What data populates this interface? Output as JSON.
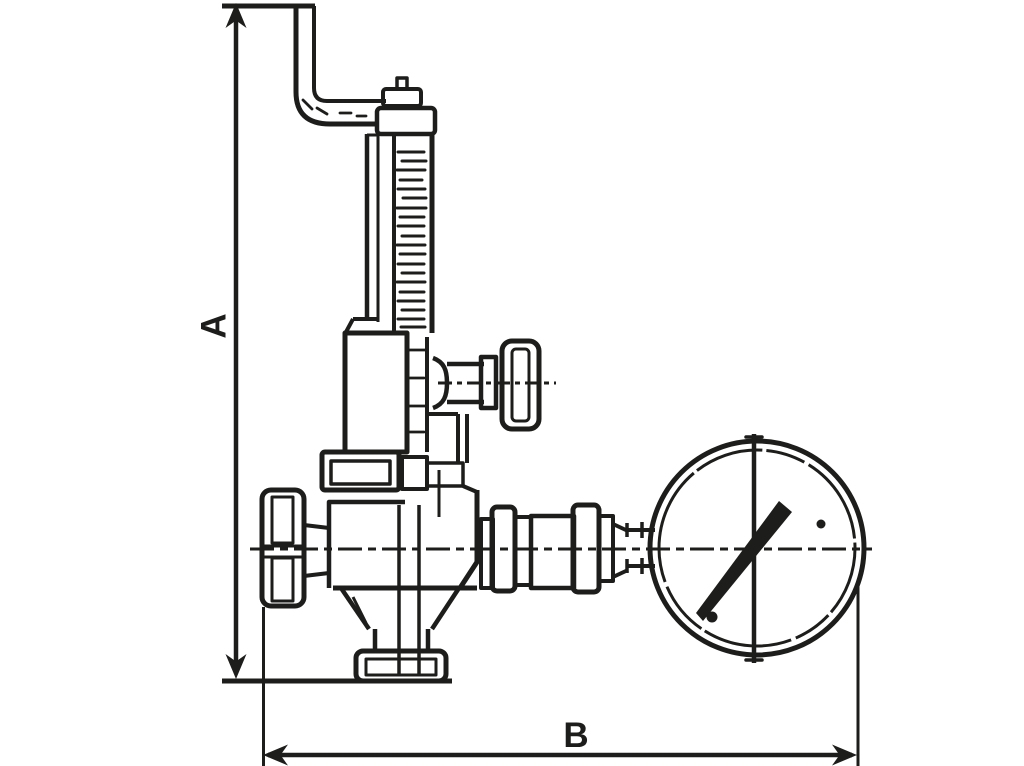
{
  "figure": {
    "kind": "technical-dimension-drawing",
    "subject": "safety relief valve with test lever and pressure gauge"
  },
  "labels": {
    "dimension_a": "A",
    "dimension_b": "B"
  },
  "colors": {
    "ink": "#1d1d1b",
    "background": "#ffffff"
  }
}
